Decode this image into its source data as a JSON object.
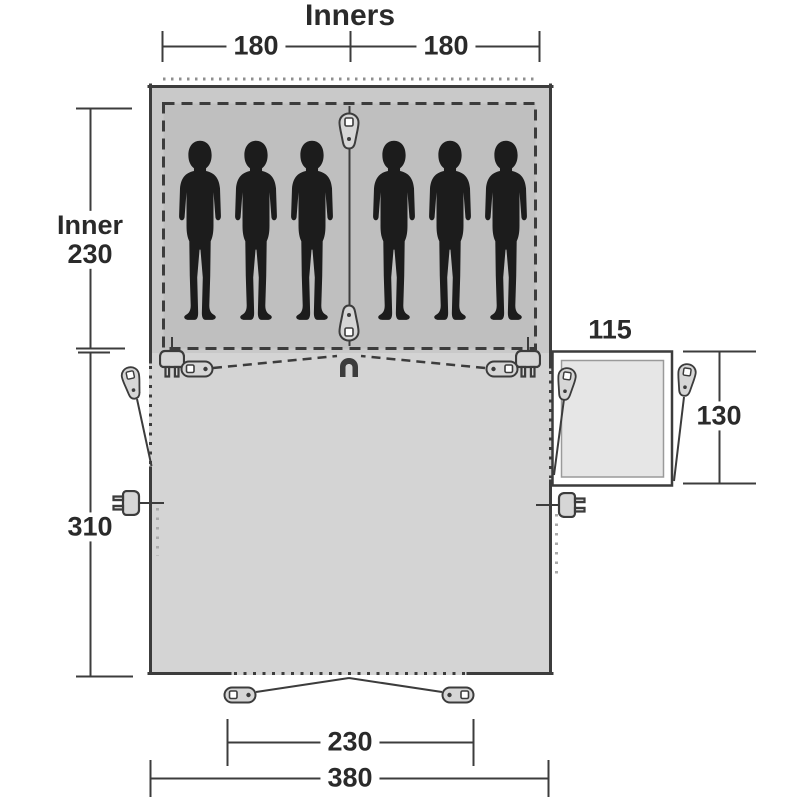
{
  "diagram": {
    "title": "Inners",
    "kind": "tent floor plan with sleeping cabins, living area and side annex",
    "occupant_silhouettes": 6
  },
  "labels": {
    "title": "Inners",
    "inner_width_left": "180",
    "inner_width_right": "180",
    "inner_depth_word": "Inner",
    "inner_depth_value": "230",
    "living_area_depth": "310",
    "annex_width": "115",
    "annex_depth": "130",
    "front_door_width": "230",
    "total_width": "380"
  },
  "icons": {
    "person": "person-silhouette",
    "zipper_pull": "teardrop zipper pull",
    "toggle_peg": "oval toggle with eyelet",
    "power_inlet": "electrical plug",
    "lantern_hook": "magnet-style hanging hook"
  },
  "colors": {
    "line": "#3c3c3c",
    "text": "#2a2a2a",
    "sleep": "#c9c9c9",
    "inner": "#bfbfbf",
    "living": "#d4d4d4",
    "annex": "#e6e6e6",
    "silhouette": "#1c1c1c",
    "peg": "#d6d6d6",
    "lightdot": "#a9a9a9",
    "dotgray": "#8f8f8f"
  }
}
